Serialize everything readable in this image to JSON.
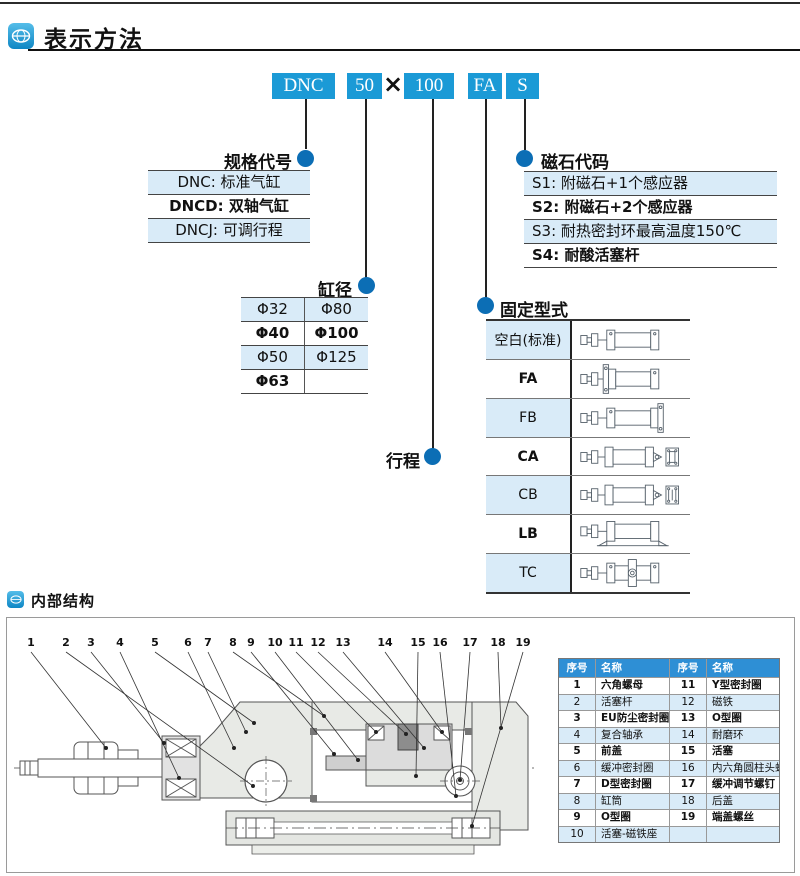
{
  "header": {
    "title": "表示方法"
  },
  "model_code": {
    "box1": "DNC",
    "box2": "50",
    "multiply": "×",
    "box3": "100",
    "box4": "FA",
    "box5": "S"
  },
  "spec_code": {
    "title": "规格代号",
    "rows": [
      "DNC: 标准气缸",
      "DNCD: 双轴气缸",
      "DNCJ: 可调行程"
    ]
  },
  "magnet_code": {
    "title": "磁石代码",
    "rows": [
      "S1: 附磁石+1个感应器",
      "S2: 附磁石+2个感应器",
      "S3: 耐热密封环最高温度150℃",
      "S4: 耐酸活塞杆"
    ]
  },
  "bore": {
    "title": "缸径",
    "rows": [
      [
        "Φ32",
        "Φ80"
      ],
      [
        "Φ40",
        "Φ100"
      ],
      [
        "Φ50",
        "Φ125"
      ],
      [
        "Φ63",
        ""
      ]
    ]
  },
  "stroke": {
    "title": "行程"
  },
  "mounting": {
    "title": "固定型式",
    "types": [
      "空白(标准)",
      "FA",
      "FB",
      "CA",
      "CB",
      "LB",
      "TC"
    ]
  },
  "internal": {
    "title": "内部结构"
  },
  "callouts": [
    "1",
    "2",
    "3",
    "4",
    "5",
    "6",
    "7",
    "8",
    "9",
    "10",
    "11",
    "12",
    "13",
    "14",
    "15",
    "16",
    "17",
    "18",
    "19"
  ],
  "parts_table": {
    "headers": [
      "序号",
      "名称",
      "序号",
      "名称"
    ],
    "rows": [
      [
        "1",
        "六角螺母",
        "11",
        "Y型密封圈"
      ],
      [
        "2",
        "活塞杆",
        "12",
        "磁铁"
      ],
      [
        "3",
        "EU防尘密封圈",
        "13",
        "O型圈"
      ],
      [
        "4",
        "复合轴承",
        "14",
        "耐磨环"
      ],
      [
        "5",
        "前盖",
        "15",
        "活塞"
      ],
      [
        "6",
        "缓冲密封圈",
        "16",
        "内六角圆柱头螺钉"
      ],
      [
        "7",
        "D型密封圈",
        "17",
        "缓冲调节螺钉"
      ],
      [
        "8",
        "缸筒",
        "18",
        "后盖"
      ],
      [
        "9",
        "O型圈",
        "19",
        "端盖螺丝"
      ],
      [
        "10",
        "活塞-磁铁座",
        "",
        ""
      ]
    ]
  },
  "colors": {
    "accent_blue": "#1b9ad6",
    "dot_blue": "#0c6eb5",
    "row_blue": "#d9ebf8",
    "table_header_blue": "#2e8fd5"
  }
}
